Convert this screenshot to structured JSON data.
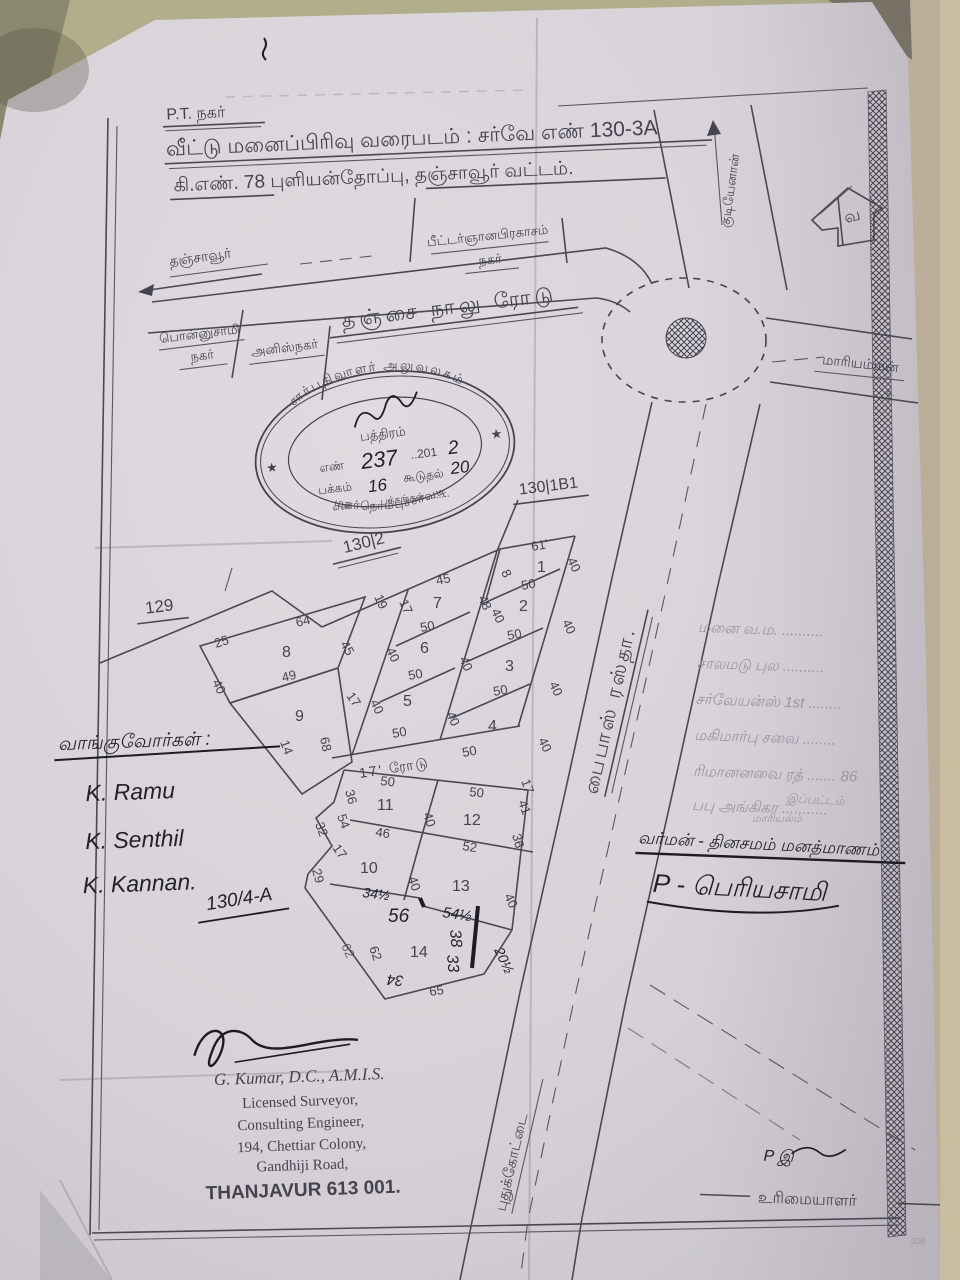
{
  "palette": {
    "bg_top": "#b2ae8c",
    "bg_right": "#c9bc9f",
    "paper": "#d9d5da",
    "ink": "#45434f",
    "hand_ink": "#23222c",
    "faint_ink": "#9b94a6"
  },
  "title": {
    "l0": "P.T. நகர்",
    "l1": "வீட்டு மனைப்பிரிவு வரைபடம் : சர்வே எண் 130-3A",
    "l2": "கி.எண். 78 புளியன்தோப்பு, தஞ்சாவூர் வட்டம்."
  },
  "compass": {
    "letter": "வ"
  },
  "roads": {
    "main": "தஞ்சை நாலு ரோடு",
    "to_thanjavur": "தஞ்சாவூர்",
    "to_mariamman": "மாரியம்மன்",
    "mariamman_mark": "உ",
    "to_kudi": "குடியேனான்",
    "bypass": "பைபாஸ் ரஸ்தா.",
    "to_pudukkottai": "புதுக்கோட்டை",
    "internal": "17' ரோடு"
  },
  "localities": {
    "peter_l1": "பீட்டர்ஞானபிரகாசம்",
    "peter_l2": "நகர்",
    "ponnusamy_l1": "பொன்னுசாமி",
    "ponnusamy_l2": "நகர்",
    "anis": "அனிஸ்நகர்"
  },
  "survey": {
    "s129": "129",
    "s130_2": "130|2",
    "s130_1b1": "130|1B1",
    "s130_4a": "130/4-A"
  },
  "seal": {
    "arc_top": "சார்பதிவாளர் அலுவலகம்",
    "arc_bottom": "மகர்நொம்புச்சாவடி",
    "doc_word": "பத்திரம்",
    "no_label": "எண்",
    "no_value": "237",
    "year_prefix": "..201",
    "year_digit": "2",
    "page_label": "பக்கம்",
    "page_value": "16",
    "addl_label": "கூடுதல்",
    "addl_value": "20",
    "pages_line": "எண் ........ பக்கங்கள் ........",
    "star": "★"
  },
  "plots": {
    "p1": {
      "no": "1",
      "top": "61'",
      "right": "40",
      "bottom": "50",
      "left": "8"
    },
    "p2": {
      "no": "2",
      "lt": "48",
      "left": "40",
      "right": "40",
      "bottom": "50"
    },
    "p3": {
      "no": "3",
      "right": "40",
      "bottom": "50"
    },
    "p4": {
      "no": "4",
      "right": "40",
      "bottom": "50"
    },
    "p5": {
      "no": "5",
      "left": "40",
      "right": "40",
      "bottom": "50"
    },
    "p6": {
      "no": "6",
      "top": "50",
      "left": "40",
      "right": "40",
      "bottom": "50"
    },
    "p7": {
      "no": "7",
      "top": "45"
    },
    "p8": {
      "no": "8",
      "tl": "25",
      "top": "64",
      "right": "45",
      "bottom": "49",
      "left": "40"
    },
    "p9": {
      "no": "9",
      "left": "14",
      "right": "68"
    },
    "p10": {
      "no": "10",
      "right": "40",
      "bottom": "34½"
    },
    "p11": {
      "no": "11",
      "top": "50",
      "left": "36",
      "right": "40",
      "bottom": "46"
    },
    "p12": {
      "no": "12",
      "top": "50",
      "rt": "41",
      "right": "36",
      "bottom": "52",
      "corner": "17"
    },
    "p13": {
      "no": "13",
      "right": "40",
      "bottom": "54½"
    },
    "p14": {
      "no": "14",
      "a38": "38",
      "a33": "33",
      "left": "62",
      "left2": "62",
      "bottom": "65",
      "corner": "34",
      "right": "20½",
      "mark56": "56"
    },
    "strip": {
      "a": "19",
      "b": "17",
      "d": "17",
      "e": "32",
      "f": "54",
      "g": "17",
      "h": "29"
    }
  },
  "buyers": {
    "heading": "வாங்குவோர்கள் :",
    "s1": "K. Ramu",
    "s2": "K. Senthil",
    "s3": "K. Kannan."
  },
  "surveyor": {
    "name": "G. Kumar, D.C., A.M.I.S.",
    "l1": "Licensed Surveyor,",
    "l2": "Consulting Engineer,",
    "l3": "194, Chettiar Colony,",
    "l4": "Gandhiji Road,",
    "l5": "THANJAVUR 613 001."
  },
  "owner": {
    "sig": "P இ",
    "label": "உரிமையாளர்",
    "corner_mark": "306"
  },
  "notes": {
    "f1": "மனை வ.ம. ..........",
    "f2": "சாலமடு புல ..........",
    "f3": "சர்வேயன்ஸ் 1st ........",
    "f4": "மகிமார்பு சவை ........",
    "f5": "ரிமானனவை ரத் ....... 86",
    "f6": "பபு அங்கிகா ...........",
    "small1": "இப்பட்டம்",
    "small2": "மாரியல்ம்",
    "dark": "வர்மன் - தினசமம் மனத்மாணம்",
    "sig": "P - பெரியசாமி"
  }
}
